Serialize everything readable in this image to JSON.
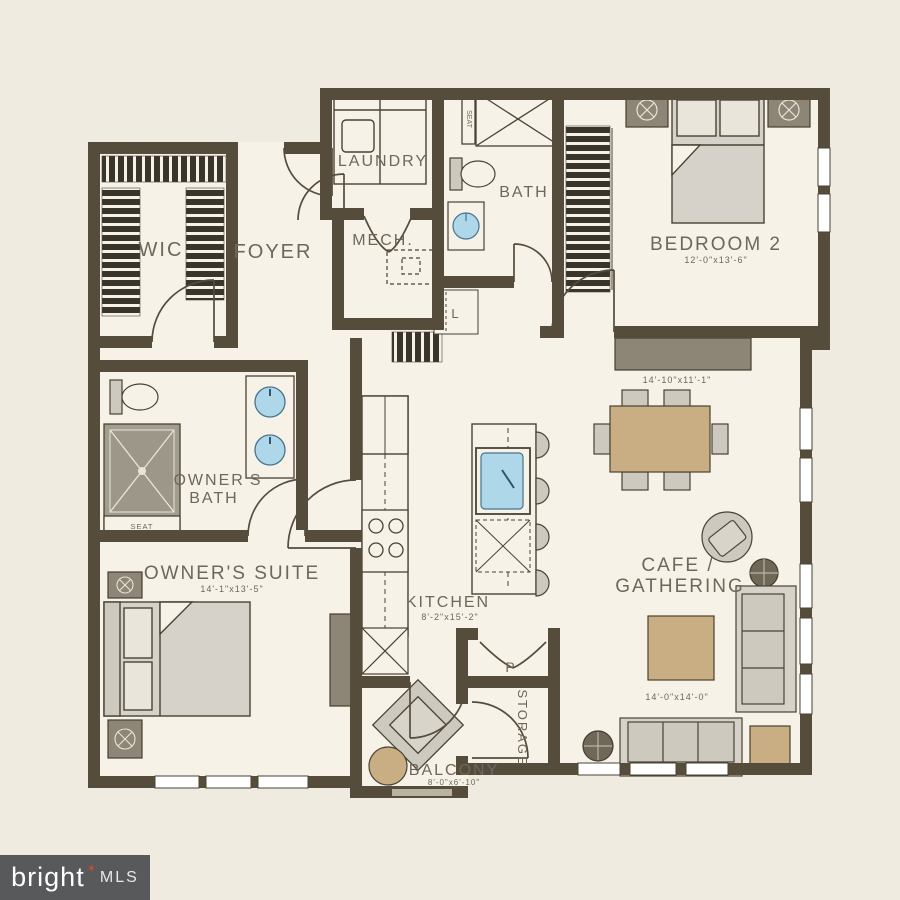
{
  "rooms": {
    "wic": {
      "label": "WIC"
    },
    "foyer": {
      "label": "FOYER"
    },
    "laundry": {
      "label": "LAUNDRY"
    },
    "mech": {
      "label": "MECH."
    },
    "bath": {
      "label": "BATH"
    },
    "bedroom2": {
      "label": "BEDROOM 2",
      "dims": "12'-0\"x13'-6\""
    },
    "dining": {
      "dims": "14'-10\"x11'-1\""
    },
    "cafe": {
      "line1": "CAFE /",
      "line2": "GATHERING",
      "dims": "14'-0\"x14'-0\""
    },
    "kitchen": {
      "label": "KITCHEN",
      "dims": "8'-2\"x15'-2\""
    },
    "owners_bath": {
      "line1": "OWNER'S",
      "line2": "BATH"
    },
    "owners_suite": {
      "label": "OWNER'S SUITE",
      "dims": "14'-1\"x13'-5\""
    },
    "balcony": {
      "label": "BALCONY",
      "dims": "8'-0\"x6'-10\""
    },
    "storage": {
      "label": "STORAGE"
    },
    "pantry": {
      "label": "P"
    },
    "linen": {
      "label": "L"
    },
    "shower_seat": {
      "label": "SEAT"
    }
  },
  "colors": {
    "background": "#efebe0",
    "floor": "#f6f2e7",
    "wall": "#564c3c",
    "label": "#6e675a",
    "furniture_gray": "#d6d2c9",
    "furniture_dark": "#8d8575",
    "tan": "#c9ad83",
    "sink_blue": "#aed7ea",
    "watermark_bg": "#58595b",
    "watermark_star": "#c8502f"
  },
  "watermark": {
    "brand": "bright",
    "star_glyph": "✶",
    "suffix": "MLS"
  }
}
